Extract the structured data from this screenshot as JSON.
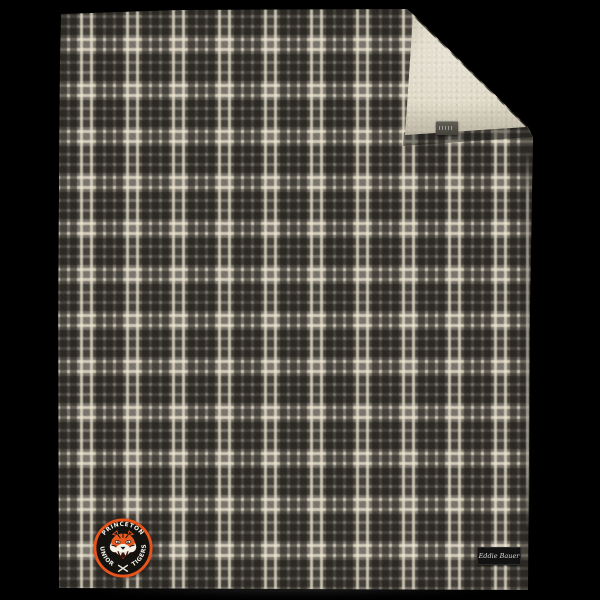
{
  "scene": {
    "background_color": "#000000",
    "description": "Product photo of a plaid flannel blanket with sherpa lining, top-right corner folded over to show the cream sherpa interior"
  },
  "blanket": {
    "plaid": {
      "base_color": "#7a756d",
      "dark_stripe_color": "#221f1b",
      "cream_stripe_color": "#f0e8d0"
    },
    "sherpa_lining_color": "#dcd6c4",
    "edge_highlight_color": "#e8e4d7"
  },
  "fold_tag": {
    "color": "#55524b"
  },
  "logo_patch": {
    "top_text": "PRINCETON",
    "bottom_left_text": "JUNIOR",
    "bottom_right_text": "TIGERS",
    "icon": "tiger-head-with-crossed-hockey-sticks",
    "ring_color": "#e8541b",
    "background_color": "#14120e",
    "text_color": "#f2efe6",
    "tiger_orange": "#ea5a1e",
    "tiger_white": "#f5f2ea"
  },
  "brand_label": {
    "text": "Eddie Bauer",
    "background_color": "#121212",
    "text_color": "#dddddd"
  }
}
